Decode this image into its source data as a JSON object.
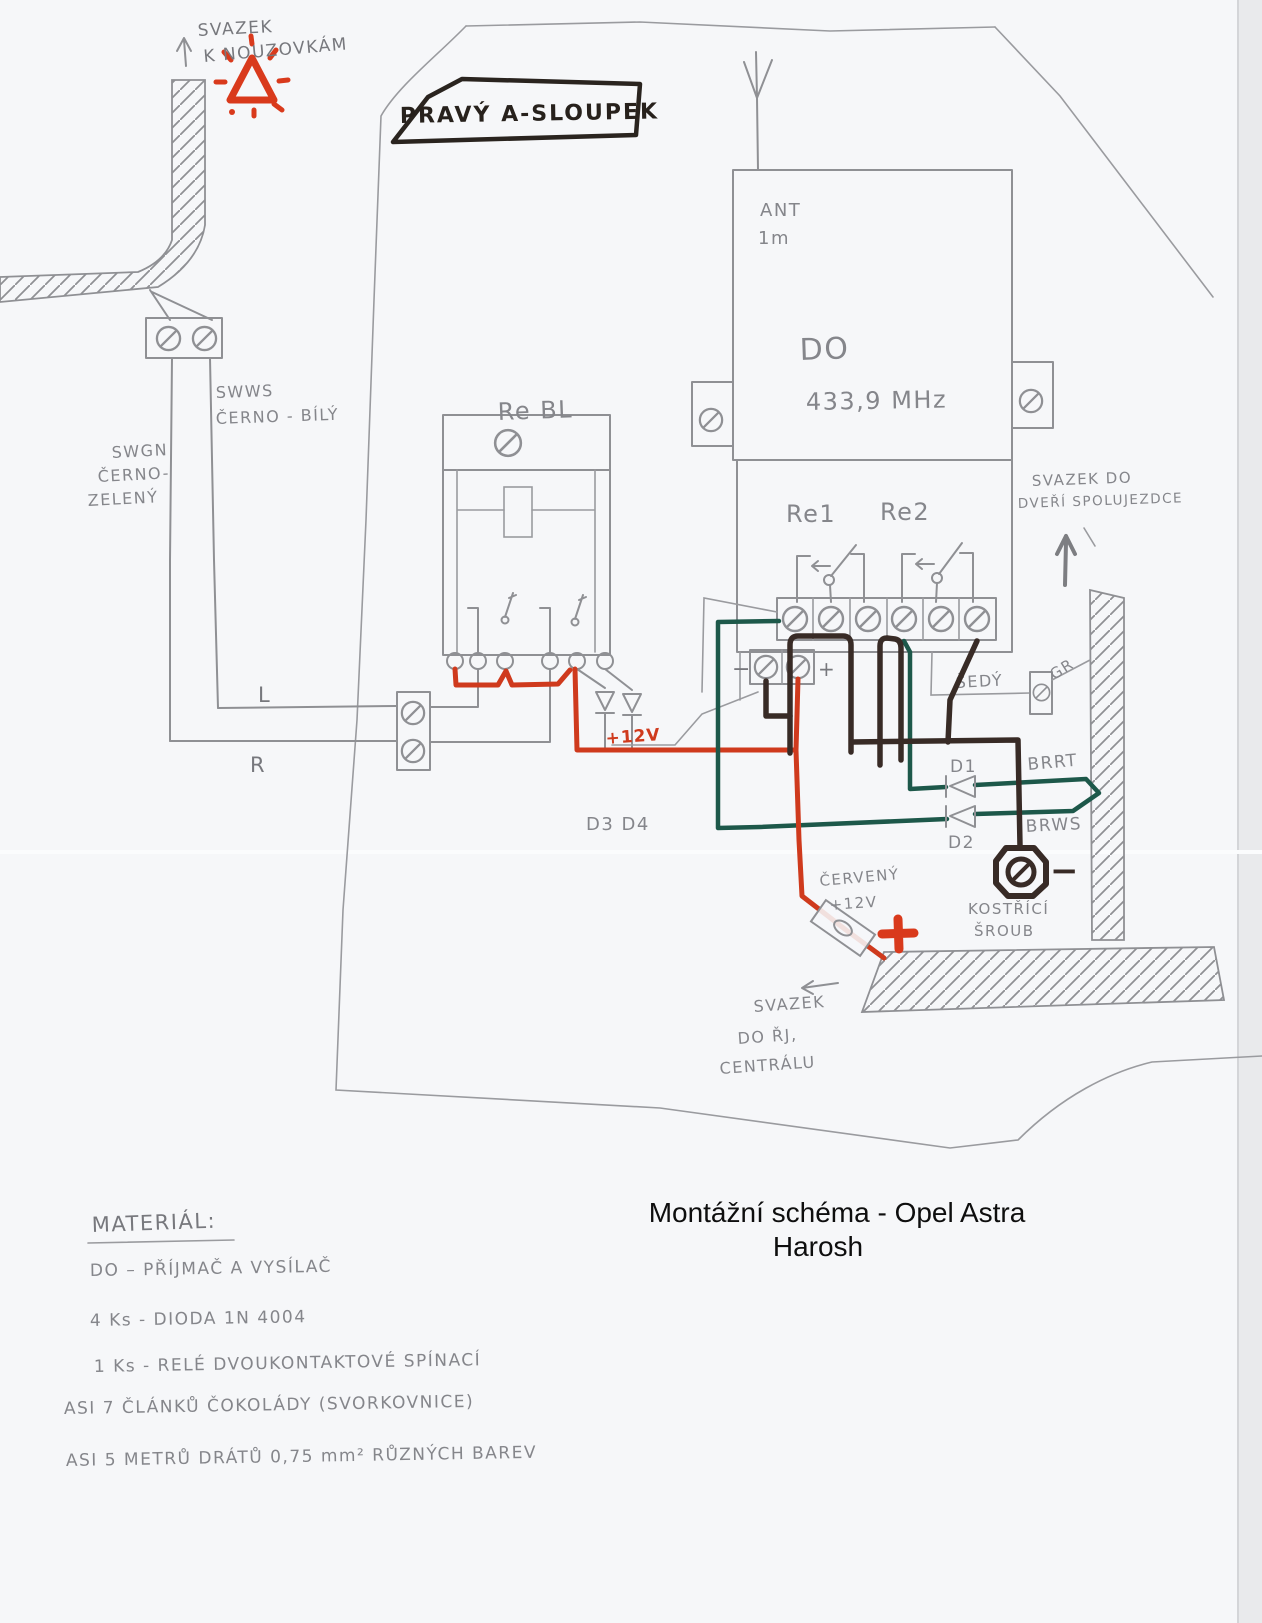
{
  "document": {
    "printed_title_line1": "Montážní schéma - Opel Astra",
    "printed_title_line2": "Harosh"
  },
  "annotations": {
    "svazek_k_nouzovkam_1": "SVAZEK",
    "svazek_k_nouzovkam_2": "K NOUZOVKÁM",
    "pravy_a_sloupek": "PRAVÝ A-SLOUPEK",
    "ant": "ANT",
    "ant_length": "1m",
    "do_label": "DO",
    "do_freq": "433,9 MHz",
    "rebl": "Re BL",
    "re1": "Re1",
    "re2": "Re2",
    "swws_code": "SWWS",
    "swws_color": "ČERNO - BÍLÝ",
    "swgn_code": "SWGN",
    "swgn_color_1": "ČERNO-",
    "swgn_color_2": "ZELENÝ",
    "wire_l": "L",
    "wire_r": "R",
    "plus12v_wire": "+12V",
    "d3d4": "D3 D4",
    "d1": "D1",
    "d2": "D2",
    "brrt": "BRRT",
    "brws": "BRWS",
    "sedy": "ŠEDÝ",
    "gr": "GR",
    "svazek_dvere_1": "SVAZEK DO",
    "svazek_dvere_2": "DVEŘÍ SPOLUJEZDCE",
    "cerveny": "ČERVENÝ",
    "cerveny_12v": "+12V",
    "battery_plus": "+",
    "kostrici_1": "KOSTŘÍCÍ",
    "kostrici_2": "ŠROUB",
    "ground_minus": "−",
    "power_minus": "−",
    "power_plus": "+",
    "svazek_rj_1": "SVAZEK",
    "svazek_rj_2": "DO ŘJ,",
    "svazek_rj_3": "CENTRÁLU"
  },
  "materials": {
    "heading": "MATERIÁL:",
    "items": [
      "DO – PŘÍJMAČ A VYSÍLAČ",
      "4 Ks - DIODA 1N 4004",
      "1 Ks - RELÉ DVOUKONTAKTOVÉ SPÍNACÍ",
      "ASI 7 ČLÁNKŮ ČOKOLÁDY (SVORKOVNICE)",
      "ASI 5 METRŮ DRÁTŮ 0,75 mm² RŮZNÝCH BAREV"
    ]
  },
  "colors": {
    "pencil": "#8f9094",
    "ink_red": "#cf3a1d",
    "ink_green": "#1d584a",
    "ink_dark": "#382b26",
    "paper": "#f6f7f9"
  }
}
